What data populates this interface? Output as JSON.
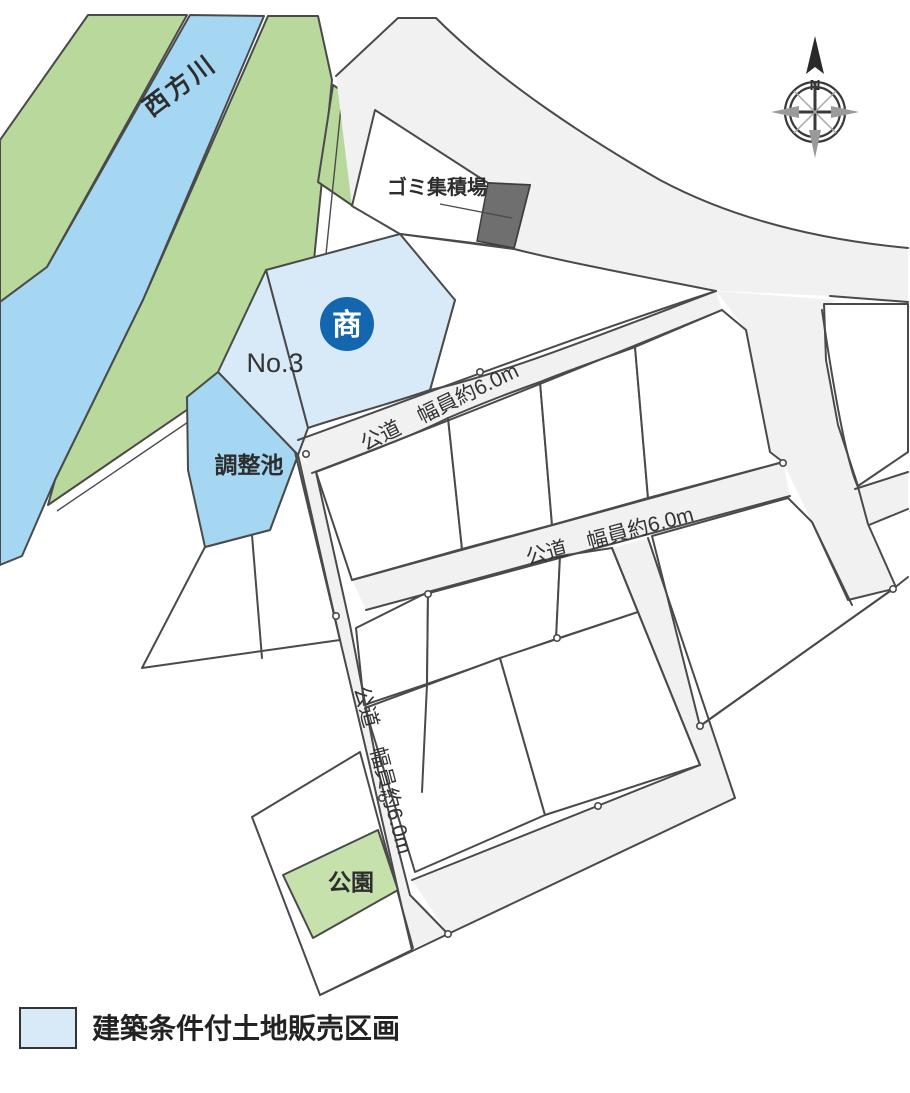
{
  "map": {
    "river": {
      "label": "西方川"
    },
    "garbage_site": {
      "label": "ゴミ集積場"
    },
    "commercial_marker": {
      "label": "商",
      "circle_color": "#1467ae"
    },
    "plot_no3": {
      "label": "No.3"
    },
    "retention_pond": {
      "label": "調整池"
    },
    "park": {
      "label": "公園"
    },
    "roads": {
      "road_b_label": "公道　幅員約6.0m",
      "road_d_label": "公道　幅員約6.0m",
      "road_e_label": "公道　幅員約6.0m"
    },
    "compass": {
      "north": "N"
    }
  },
  "legend": {
    "items": [
      {
        "swatch_color": "#d8eaf8",
        "label": "建築条件付土地販売区画"
      }
    ]
  },
  "colors": {
    "river_water": "#a5d7f2",
    "pond_water": "#a5d7f2",
    "river_bank_green": "#b9d89c",
    "park_green": "#c6e1ac",
    "sale_plot_blue": "#d8eaf8",
    "road_gray": "#f1f1f2",
    "plot_white": "#ffffff",
    "outline": "#4a4a4a",
    "garbage_gray": "#6f6f6f",
    "commercial_blue": "#1467ae",
    "text": "#2d2d2d"
  }
}
